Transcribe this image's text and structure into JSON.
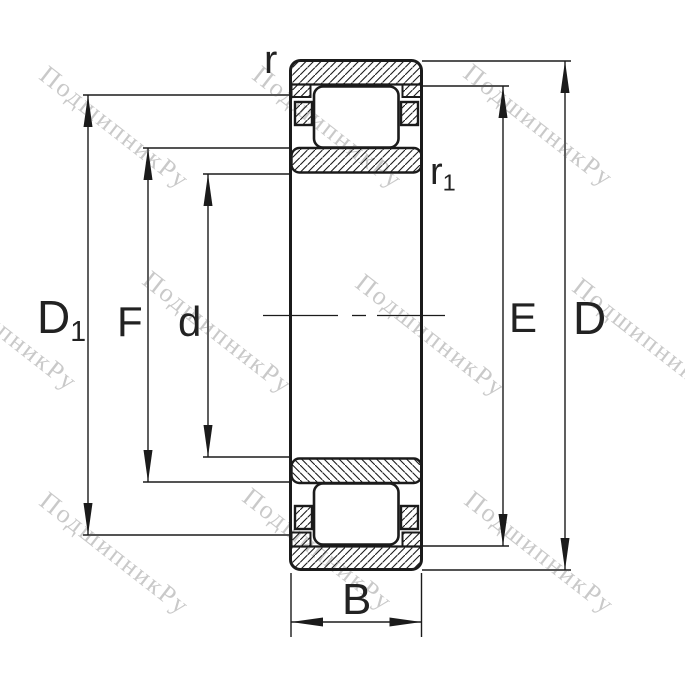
{
  "watermark": {
    "text": "ПодшипникРу"
  },
  "labels": {
    "r": "r",
    "r1_base": "r",
    "r1_sub": "1",
    "D1_base": "D",
    "D1_sub": "1",
    "F": "F",
    "d": "d",
    "E": "E",
    "D": "D",
    "B": "B"
  }
}
